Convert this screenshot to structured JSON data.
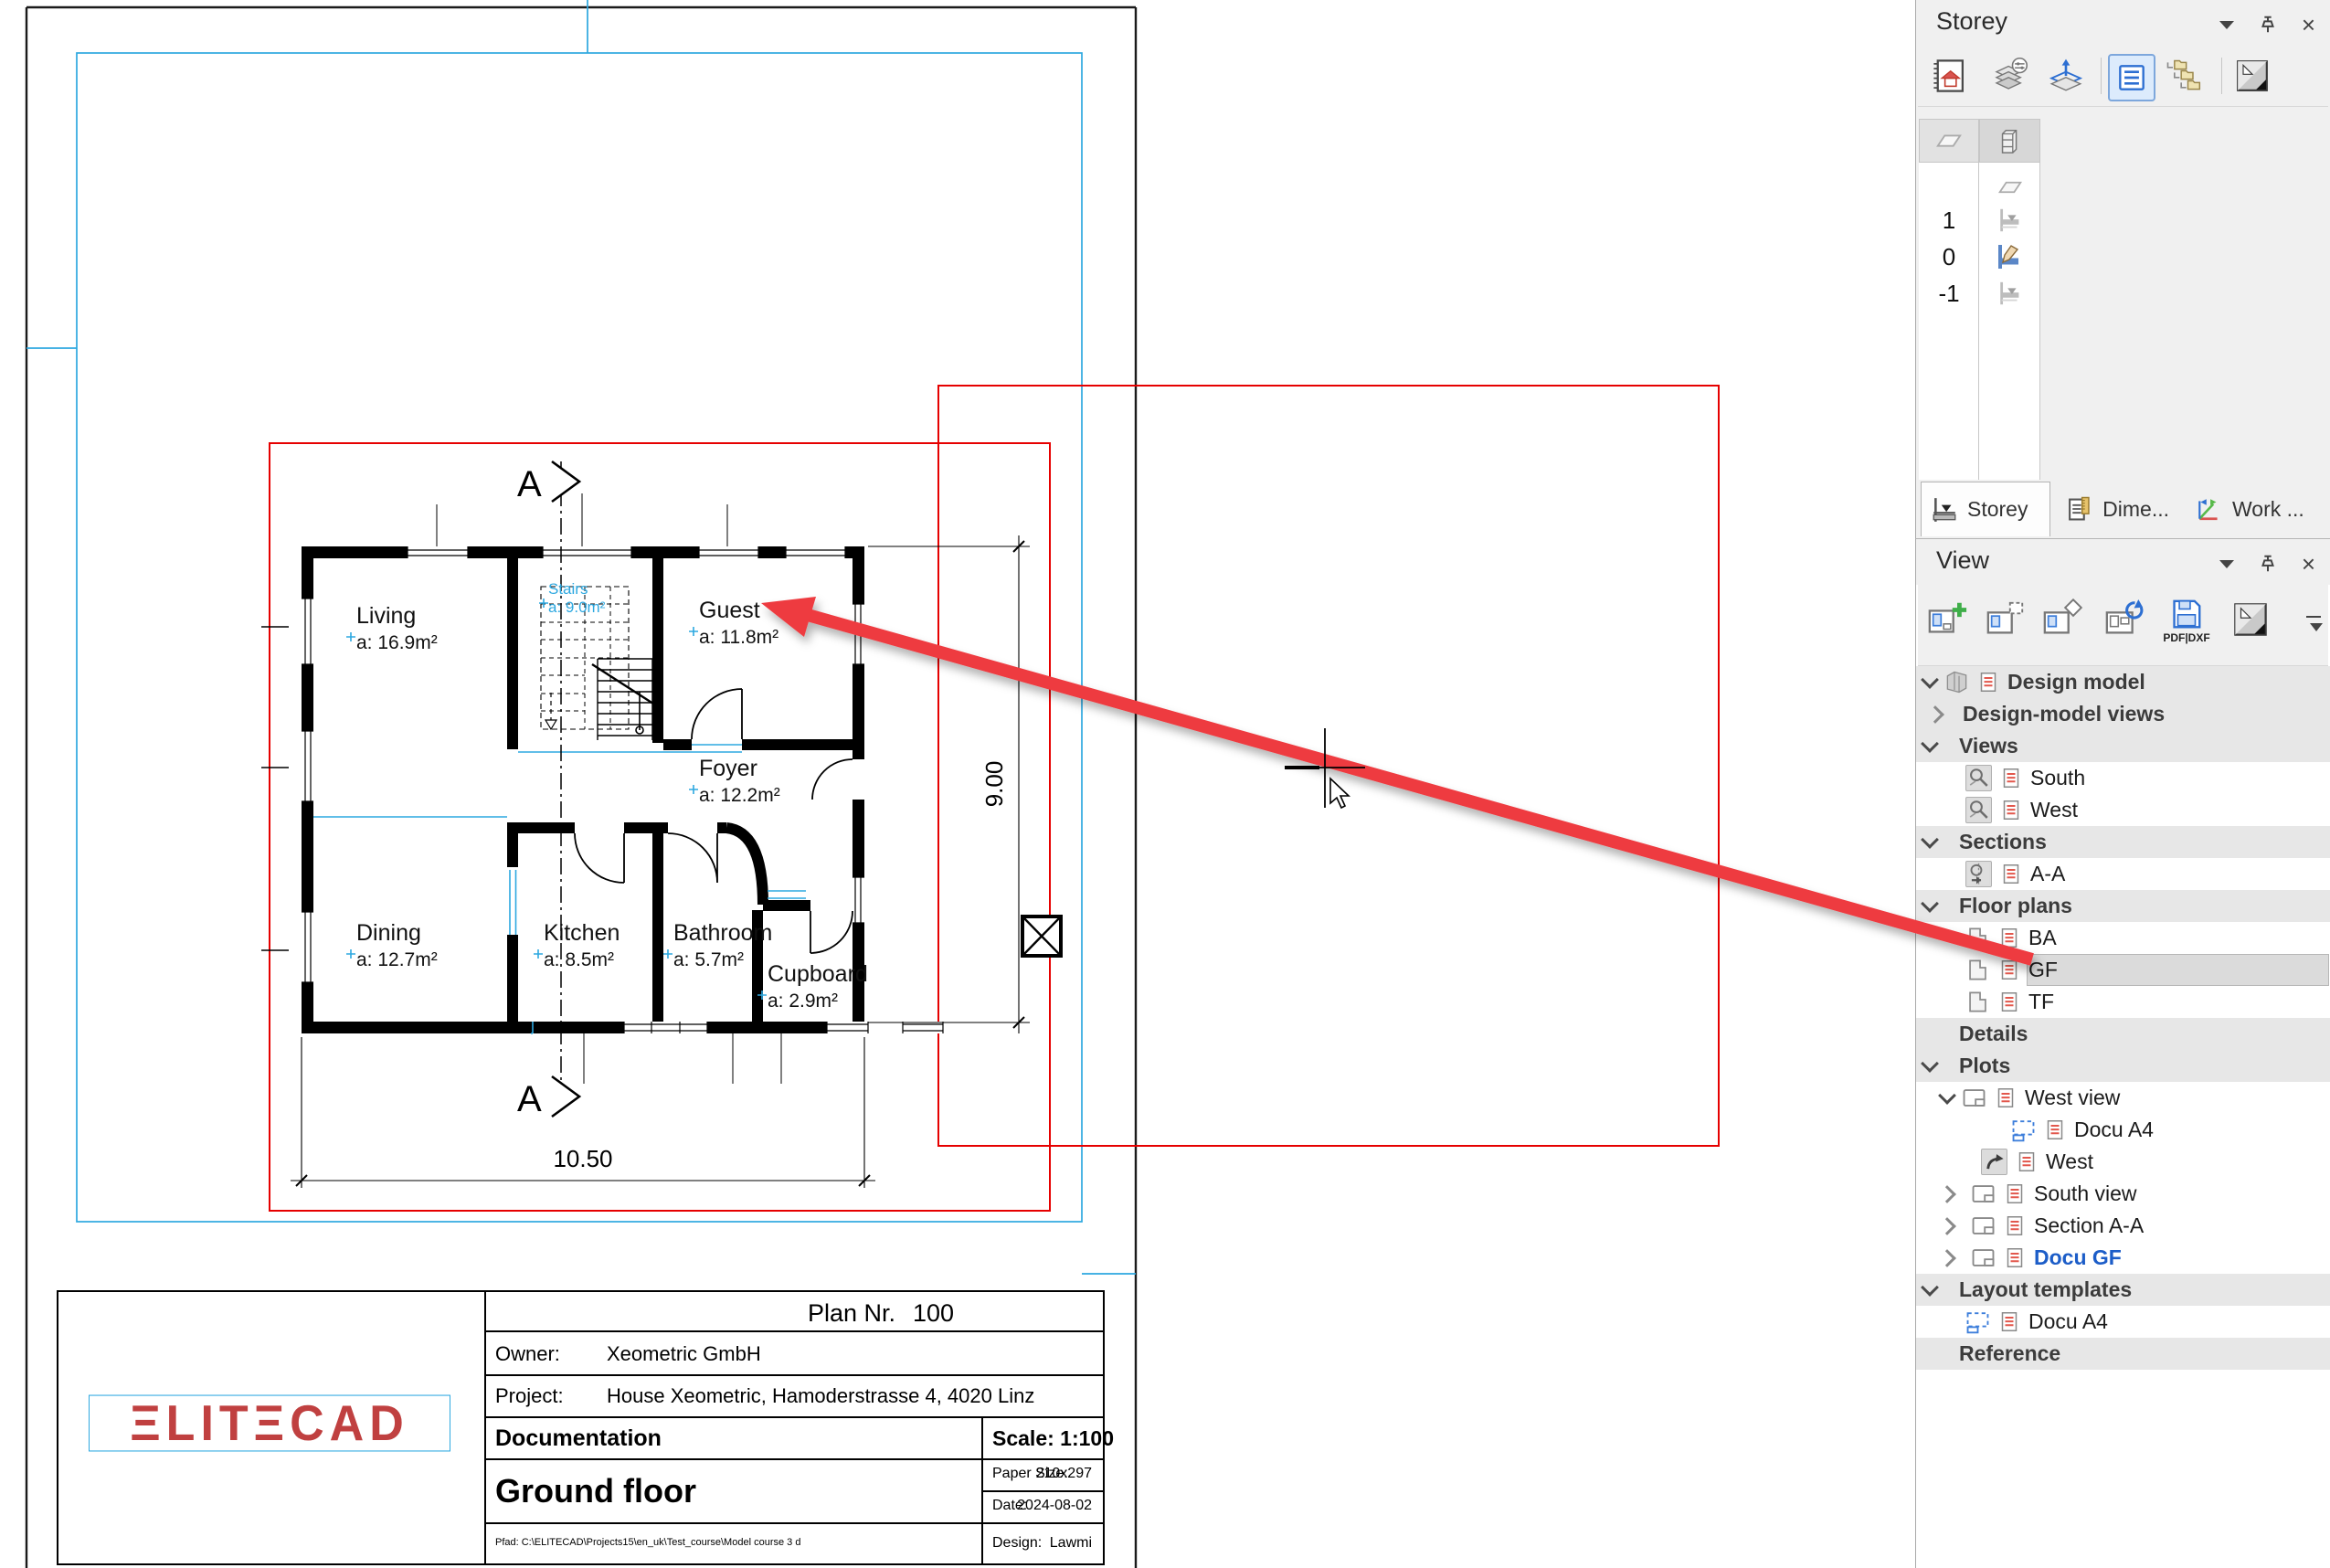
{
  "icons": {
    "close": "×"
  },
  "storey_panel": {
    "title": "Storey",
    "levels": [
      {
        "label": "1"
      },
      {
        "label": "0"
      },
      {
        "label": "-1"
      }
    ],
    "tabs": [
      {
        "label": "Storey"
      },
      {
        "label": "Dime..."
      },
      {
        "label": "Work ..."
      }
    ]
  },
  "view_panel": {
    "title": "View",
    "pdf_button_label": "PDF|DXF",
    "tree": [
      {
        "label": "Design model"
      },
      {
        "label": "Design-model views"
      },
      {
        "label": "Views"
      },
      {
        "label": "South"
      },
      {
        "label": "West"
      },
      {
        "label": "Sections"
      },
      {
        "label": "A-A"
      },
      {
        "label": "Floor plans"
      },
      {
        "label": "BA"
      },
      {
        "label": "GF"
      },
      {
        "label": "TF"
      },
      {
        "label": "Details"
      },
      {
        "label": "Plots"
      },
      {
        "label": "West view"
      },
      {
        "label": "Docu A4"
      },
      {
        "label": "West"
      },
      {
        "label": "South view"
      },
      {
        "label": "Section A-A"
      },
      {
        "label": "Docu GF"
      },
      {
        "label": "Layout templates"
      },
      {
        "label": "Docu A4"
      },
      {
        "label": "Reference"
      }
    ]
  },
  "drawing": {
    "rooms": [
      {
        "name": "Living",
        "area": "a: 16.9m²"
      },
      {
        "name": "Guest",
        "area": "a: 11.8m²"
      },
      {
        "name": "Foyer",
        "area": "a: 12.2m²"
      },
      {
        "name": "Dining",
        "area": "a: 12.7m²"
      },
      {
        "name": "Kitchen",
        "area": "a: 8.5m²"
      },
      {
        "name": "Bathroom",
        "area": "a: 5.7m²"
      },
      {
        "name": "Cupboard",
        "area": "a: 2.9m²"
      }
    ],
    "stairs": {
      "name": "Stairs",
      "area": "a: 9.0m²"
    },
    "section_label": "A",
    "dim_width": "10.50",
    "dim_height": "9.00",
    "colors": {
      "accent_cyan": "#2da8e0",
      "frame_red": "#e60000",
      "arrow_red": "#ee3a3f",
      "logo_red": "#c04040"
    },
    "title_block": {
      "plan_nr_label": "Plan Nr.",
      "plan_nr_value": "100",
      "owner_label": "Owner:",
      "owner_value": "Xeometric GmbH",
      "project_label": "Project:",
      "project_value": "House Xeometric, Hamoderstrasse 4, 4020 Linz",
      "doc_title": "Documentation",
      "scale_label": "Scale: 1:100",
      "floor_title": "Ground floor",
      "paper_label": "Paper Size:",
      "paper_value": "210x297",
      "date_label": "Date:",
      "date_value": "2024-08-02",
      "path_text": "Pfad: C:\\ELITECAD\\Projects15\\en_uk\\Test_course\\Model course 3 d",
      "design_label": "Design:",
      "design_value": "Lawmi",
      "logo_text": "ΞLITΞCAD"
    }
  }
}
